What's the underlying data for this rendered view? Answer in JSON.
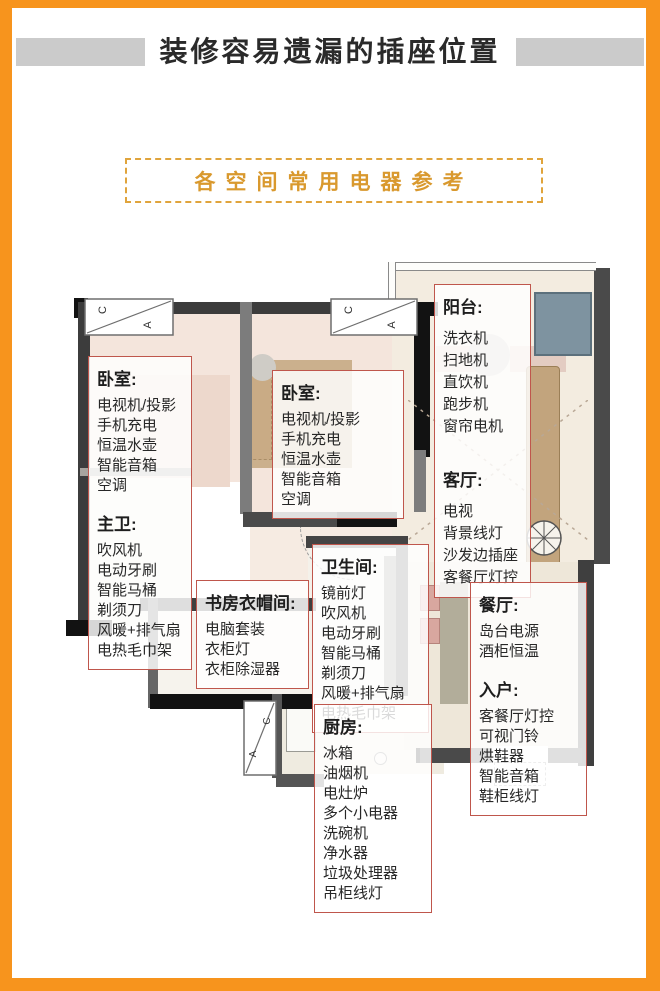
{
  "title": "装修容易遗漏的插座位置",
  "subtitle": "各空间常用电器参考",
  "window_marks": {
    "c": "C",
    "a": "A"
  },
  "colors": {
    "frame_orange": "#F7941D",
    "subtitle_gold": "#D9992E",
    "label_box_border_red": "#BF564C",
    "wall_dark": "#3C3C3C",
    "floor_pink": "#F4E5DC",
    "wood_tan": "#C2A47D",
    "washer_blue": "#7E93A0"
  },
  "rooms": [
    {
      "name": "卧室:",
      "items": [
        "电视机/投影",
        "手机充电",
        "恒温水壶",
        "智能音箱",
        "空调"
      ]
    },
    {
      "name": "主卫:",
      "items": [
        "吹风机",
        "电动牙刷",
        "智能马桶",
        "剃须刀",
        "风暖+排气扇",
        "电热毛巾架"
      ]
    },
    {
      "name": "卧室:",
      "items": [
        "电视机/投影",
        "手机充电",
        "恒温水壶",
        "智能音箱",
        "空调"
      ]
    },
    {
      "name": "阳台:",
      "items": [
        "洗衣机",
        "扫地机",
        "直饮机",
        "跑步机",
        "窗帘电机"
      ]
    },
    {
      "name": "客厅:",
      "items": [
        "电视",
        "背景线灯",
        "沙发边插座",
        "客餐厅灯控"
      ]
    },
    {
      "name": "卫生间:",
      "items": [
        "镜前灯",
        "吹风机",
        "电动牙刷",
        "智能马桶",
        "剃须刀",
        "风暖+排气扇",
        "电热毛巾架"
      ]
    },
    {
      "name": "书房衣帽间:",
      "items": [
        "电脑套装",
        "衣柜灯",
        "衣柜除湿器"
      ]
    },
    {
      "name": "餐厅:",
      "items": [
        "岛台电源",
        "酒柜恒温"
      ]
    },
    {
      "name": "入户:",
      "items": [
        "客餐厅灯控",
        "可视门铃",
        "烘鞋器",
        "智能音箱",
        "鞋柜线灯"
      ]
    },
    {
      "name": "厨房:",
      "items": [
        "冰箱",
        "油烟机",
        "电灶炉",
        "多个小电器",
        "洗碗机",
        "净水器",
        "垃圾处理器",
        "吊柜线灯"
      ]
    }
  ]
}
